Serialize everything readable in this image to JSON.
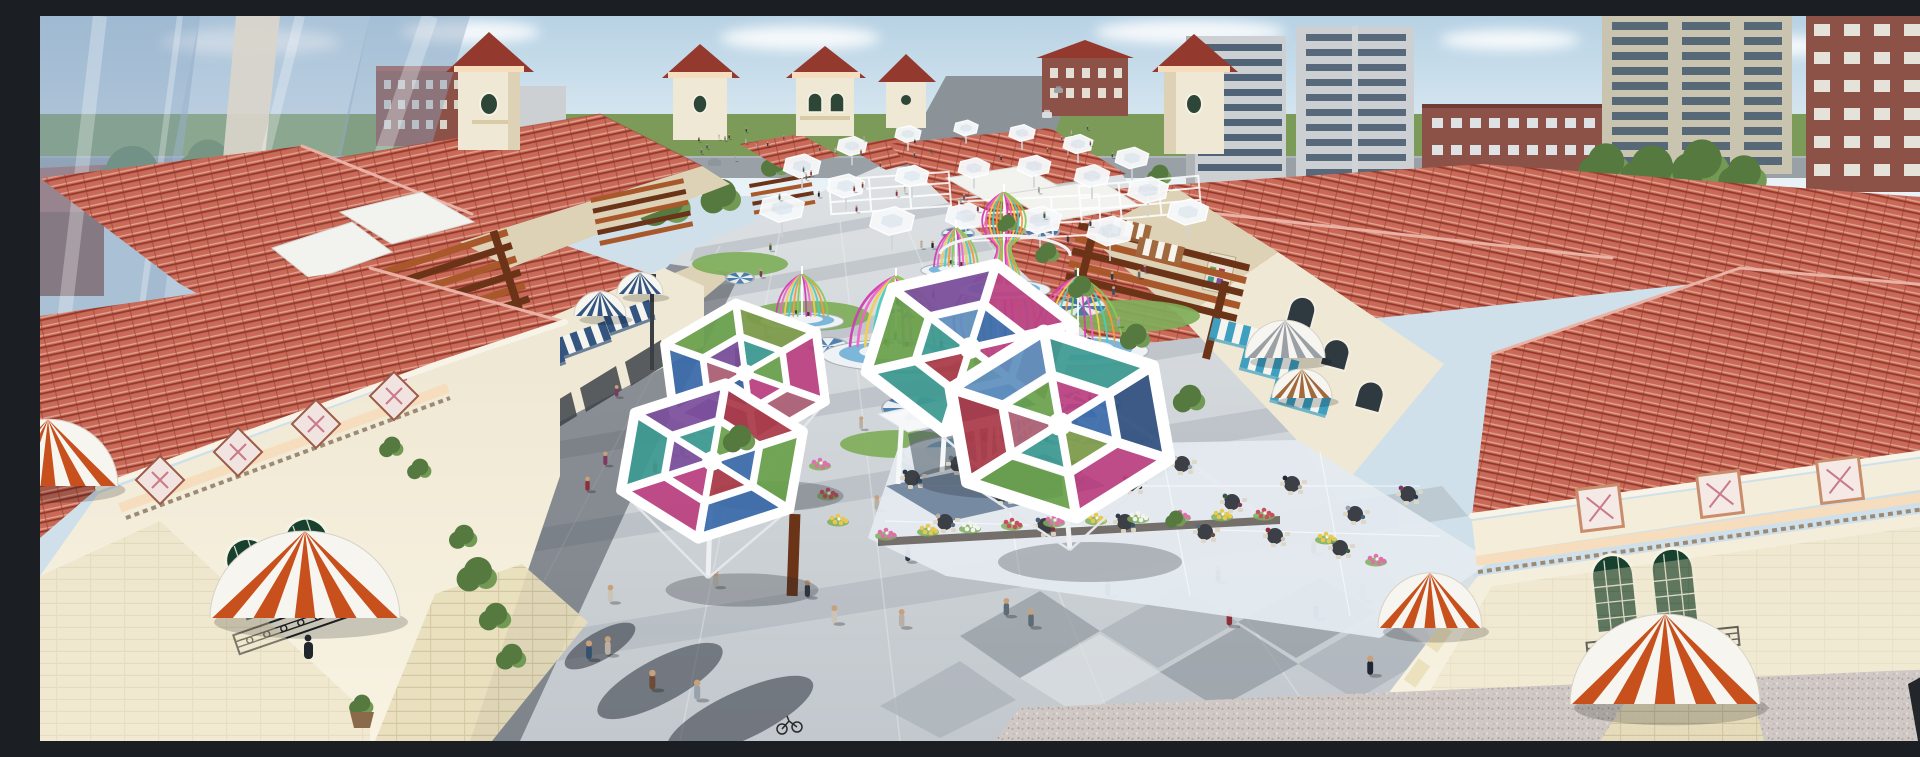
{
  "scene": {
    "setting": "aerial 3D architectural rendering of an outdoor Mediterranean-style shopping plaza",
    "time": "daytime",
    "features": [
      "red tiled roofs",
      "cream stucco buildings",
      "pedestrian plaza with crowds",
      "stained-glass hexagonal canopies",
      "ribbon cage pavilions",
      "striped dome awnings",
      "outdoor cafe terrace",
      "city towers in background"
    ]
  },
  "palette": {
    "sky_top": "#b7d2e4",
    "sky_low": "#e9f2f7",
    "cloud": "#ffffff",
    "grass": "#7d9b58",
    "road": "#99a1a7",
    "road_far": "#8b9399",
    "glass": "#8ba5c2",
    "glass_core": "#d9d5cb",
    "roof": "#c86a57",
    "roof_light": "#e6a796",
    "roof_dark": "#93392e",
    "roof_ridge": "#e9b2a4",
    "wall": "#efe8d4",
    "wall_shade": "#ddd2b6",
    "stone": "#e8debb",
    "stone_joint": "#cfc39a",
    "frieze": "#f6ddbd",
    "tile_pink": "#c97a8a",
    "window_green": "#17402e",
    "iron": "#23252a",
    "paving": "#c3c9ce",
    "paving_light": "#dfe3e6",
    "paving_mid": "#a8afb6",
    "paving_dark": "#8d959c",
    "granite": "#cfc8c4",
    "shadow": "rgba(35,40,50,0.35)",
    "pergola": "#a8582b",
    "pergola_dark": "#6b3317",
    "awning_orange": "#c7501d",
    "awning_blue": "#33557f",
    "awning_teal": "#3e9fc0",
    "awning_tan": "#a06a3e",
    "awning_gray": "#9aa0a6",
    "lawn": "#7fae5a",
    "tree": "#55793f",
    "tree_light": "#729a55",
    "water": "#7cb7da",
    "water_deep": "#4179ab",
    "plat_white": "#eef2f5",
    "brick": "#8d5247",
    "tower_gray": "#ccd0d2",
    "tower_beige": "#c9c4b0",
    "win_dark": "#44586e",
    "canopy_green": "#6aa14c",
    "canopy_magenta": "#bb4181",
    "canopy_rose": "#ad5f75",
    "canopy_blue": "#3c6cab",
    "canopy_teal": "#3d9a92",
    "canopy_purple": "#7b4f9c",
    "canopy_red": "#aa3a48",
    "canopy_olive": "#7d9b4a",
    "canopy_navy": "#31517f",
    "canopy_sky": "#6090bf",
    "ribbon_pink": "#f263c8",
    "ribbon_magenta": "#cf3fae",
    "ribbon_yellow": "#f2cf4f",
    "ribbon_orange": "#f29b3d",
    "ribbon_teal": "#49ccba",
    "ribbon_green": "#86c95c",
    "ribbon_white": "#ffffff",
    "flower_pink": "#e06fae",
    "flower_yellow": "#e8c94f",
    "flower_white": "#f2f2ee",
    "flower_red": "#c94f5f",
    "table_dark": "#3c4046",
    "chair_cream": "#ddd6c2",
    "skin": "#c9a07c"
  },
  "scene_items": {
    "trees_bg": [
      [
        92,
        166,
        38
      ],
      [
        168,
        152,
        30
      ],
      [
        244,
        170,
        26
      ],
      [
        470,
        172,
        44
      ],
      [
        566,
        186,
        33
      ],
      [
        626,
        190,
        26
      ],
      [
        682,
        182,
        20
      ],
      [
        1566,
        152,
        26
      ],
      [
        1612,
        158,
        30
      ],
      [
        1662,
        150,
        28
      ],
      [
        1704,
        162,
        24
      ],
      [
        736,
        150,
        14
      ],
      [
        1120,
        160,
        12
      ]
    ],
    "trees_fg": [
      [
        1008,
        238,
        12
      ],
      [
        1042,
        272,
        13
      ],
      [
        1096,
        322,
        15
      ],
      [
        1150,
        384,
        16
      ],
      [
        968,
        208,
        10
      ],
      [
        438,
        560,
        20
      ],
      [
        456,
        602,
        16
      ],
      [
        472,
        642,
        15
      ],
      [
        424,
        522,
        14
      ],
      [
        352,
        432,
        12
      ],
      [
        380,
        454,
        12
      ],
      [
        700,
        424,
        16
      ],
      [
        322,
        690,
        12
      ],
      [
        1136,
        504,
        10
      ]
    ],
    "cars": [
      [
        628,
        146,
        16,
        7,
        "#b8bec2"
      ],
      [
        668,
        144,
        13,
        6,
        "#8f979c"
      ],
      [
        948,
        130,
        14,
        9,
        "#c2553a"
      ],
      [
        1002,
        96,
        10,
        6,
        "#dadde0"
      ],
      [
        1014,
        72,
        9,
        5,
        "#9aa2a8"
      ]
    ],
    "awnings": [
      [
        492,
        336,
        56,
        20,
        -20,
        "awning_blue"
      ],
      [
        540,
        314,
        52,
        19,
        -20,
        "awning_blue"
      ],
      [
        586,
        292,
        48,
        18,
        -20,
        "awning_blue"
      ],
      [
        350,
        404,
        66,
        24,
        -19,
        "awning_tan"
      ],
      [
        398,
        382,
        62,
        22,
        -19,
        "awning_tan"
      ],
      [
        1090,
        205,
        44,
        16,
        13,
        "awning_tan"
      ],
      [
        1122,
        226,
        46,
        17,
        13,
        "awning_tan"
      ],
      [
        1200,
        308,
        54,
        20,
        14,
        "awning_teal"
      ],
      [
        1232,
        338,
        56,
        21,
        15,
        "awning_teal"
      ],
      [
        1264,
        370,
        58,
        22,
        16,
        "awning_teal"
      ]
    ],
    "domes": [
      [
        265,
        602,
        95,
        60,
        "awning_orange"
      ],
      [
        8,
        470,
        70,
        46,
        "awning_orange"
      ],
      [
        1390,
        612,
        52,
        38,
        "awning_orange"
      ],
      [
        1625,
        688,
        95,
        62,
        "awning_orange"
      ],
      [
        1245,
        342,
        40,
        26,
        "awning_gray"
      ],
      [
        1262,
        382,
        30,
        20,
        "awning_tan"
      ],
      [
        560,
        300,
        26,
        17,
        "awning_blue"
      ],
      [
        600,
        278,
        23,
        15,
        "awning_blue"
      ]
    ],
    "lawns": [
      [
        700,
        248,
        48,
        12
      ],
      [
        768,
        300,
        62,
        15
      ],
      [
        872,
        342,
        70,
        16
      ],
      [
        1090,
        300,
        70,
        16
      ],
      [
        1010,
        452,
        120,
        22
      ],
      [
        860,
        428,
        60,
        14
      ]
    ],
    "medallions": [
      [
        868,
        293,
        22
      ],
      [
        1042,
        290,
        24
      ],
      [
        872,
        392,
        30
      ],
      [
        1048,
        388,
        32
      ],
      [
        918,
        218,
        16
      ],
      [
        1002,
        215,
        17
      ],
      [
        788,
        330,
        20
      ],
      [
        700,
        262,
        14
      ]
    ],
    "cages": [
      {
        "cx": 958,
        "baseY": 425,
        "w": 118,
        "h": 175,
        "type": "bulb"
      },
      {
        "cx": 856,
        "baseY": 330,
        "w": 92,
        "h": 70,
        "type": "dome"
      },
      {
        "cx": 1038,
        "baseY": 326,
        "w": 88,
        "h": 66,
        "type": "dome"
      },
      {
        "cx": 964,
        "baseY": 268,
        "w": 58,
        "h": 92,
        "type": "bulb"
      },
      {
        "cx": 916,
        "baseY": 250,
        "w": 44,
        "h": 38,
        "type": "dome"
      },
      {
        "cx": 762,
        "baseY": 300,
        "w": 52,
        "h": 42,
        "type": "dome"
      }
    ],
    "cage_colors": [
      "ribbon_magenta",
      "ribbon_pink",
      "ribbon_yellow",
      "ribbon_teal",
      "ribbon_orange",
      "ribbon_green",
      "ribbon_white"
    ],
    "umbrellas": [
      [
        762,
        150,
        20
      ],
      [
        812,
        130,
        16
      ],
      [
        868,
        118,
        14
      ],
      [
        926,
        112,
        13
      ],
      [
        982,
        117,
        14
      ],
      [
        1038,
        128,
        16
      ],
      [
        1092,
        142,
        18
      ],
      [
        742,
        192,
        24
      ],
      [
        806,
        170,
        20
      ],
      [
        872,
        160,
        18
      ],
      [
        934,
        152,
        17
      ],
      [
        994,
        150,
        18
      ],
      [
        1052,
        160,
        19
      ],
      [
        1108,
        174,
        22
      ],
      [
        852,
        205,
        24
      ],
      [
        926,
        200,
        22
      ],
      [
        1000,
        204,
        23
      ],
      [
        1070,
        215,
        25
      ],
      [
        1148,
        196,
        22
      ]
    ],
    "canopies": [
      {
        "cx": 705,
        "cy": 357,
        "r": 88,
        "rot": -6,
        "pole": [
          715,
          468
        ],
        "panels": [
          "canopy_olive",
          "canopy_magenta",
          "canopy_rose",
          "canopy_purple",
          "canopy_blue",
          "canopy_green",
          "canopy_teal",
          "canopy_green",
          "canopy_magenta",
          "canopy_blue",
          "canopy_rose",
          "canopy_purple"
        ]
      },
      {
        "cx": 672,
        "cy": 445,
        "r": 98,
        "rot": 8,
        "pole": [
          668,
          562
        ],
        "panels": [
          "canopy_red",
          "canopy_green",
          "canopy_blue",
          "canopy_magenta",
          "canopy_teal",
          "canopy_purple",
          "canopy_green",
          "canopy_blue",
          "canopy_red",
          "canopy_magenta",
          "canopy_purple",
          "canopy_teal"
        ]
      },
      {
        "cx": 930,
        "cy": 332,
        "r": 108,
        "rot": 14,
        "pole": [
          940,
          452
        ],
        "panels": [
          "canopy_magenta",
          "canopy_rose",
          "canopy_blue",
          "canopy_teal",
          "canopy_green",
          "canopy_purple",
          "canopy_blue",
          "canopy_magenta",
          "canopy_green",
          "canopy_red",
          "canopy_teal",
          "canopy_sky"
        ]
      },
      {
        "cx": 1020,
        "cy": 408,
        "r": 118,
        "rot": -8,
        "pole": [
          1030,
          534
        ],
        "panels": [
          "canopy_teal",
          "canopy_navy",
          "canopy_magenta",
          "canopy_green",
          "canopy_red",
          "canopy_sky",
          "canopy_magenta",
          "canopy_blue",
          "canopy_olive",
          "canopy_teal",
          "canopy_rose",
          "canopy_green"
        ]
      }
    ],
    "tables": [
      [
        872,
        462
      ],
      [
        918,
        448
      ],
      [
        962,
        478
      ],
      [
        1032,
        452
      ],
      [
        1092,
        468
      ],
      [
        1142,
        448
      ],
      [
        1192,
        486
      ],
      [
        1252,
        468
      ],
      [
        1315,
        498
      ],
      [
        1368,
        478
      ],
      [
        905,
        506
      ],
      [
        1005,
        510
      ],
      [
        1085,
        506
      ],
      [
        1165,
        516
      ],
      [
        1235,
        520
      ],
      [
        1300,
        532
      ]
    ],
    "flowers": [
      [
        846,
        518,
        "flower_pink"
      ],
      [
        888,
        514,
        "flower_yellow"
      ],
      [
        930,
        511,
        "flower_white"
      ],
      [
        972,
        508,
        "flower_red"
      ],
      [
        1014,
        505,
        "flower_pink"
      ],
      [
        1056,
        503,
        "flower_yellow"
      ],
      [
        1098,
        501,
        "flower_white"
      ],
      [
        1140,
        500,
        "flower_pink"
      ],
      [
        1182,
        499,
        "flower_yellow"
      ],
      [
        1224,
        498,
        "flower_red"
      ],
      [
        780,
        448,
        "flower_pink"
      ],
      [
        788,
        478,
        "flower_red"
      ],
      [
        798,
        504,
        "flower_yellow"
      ],
      [
        1286,
        522,
        "flower_yellow"
      ],
      [
        1336,
        544,
        "flower_pink"
      ],
      [
        1394,
        565,
        "flower_yellow"
      ],
      [
        1428,
        584,
        "flower_white"
      ]
    ],
    "crowd": {
      "count": 105,
      "seed": 11,
      "colors": [
        "#2f3a46",
        "#5d6b77",
        "#8c2f3b",
        "#33526e",
        "#6e4a38",
        "#c9c3b8",
        "#3c5a43",
        "#1f2732",
        "#97a2ab",
        "#7c3b5e",
        "#b8b0a4",
        "#46607a"
      ]
    }
  }
}
